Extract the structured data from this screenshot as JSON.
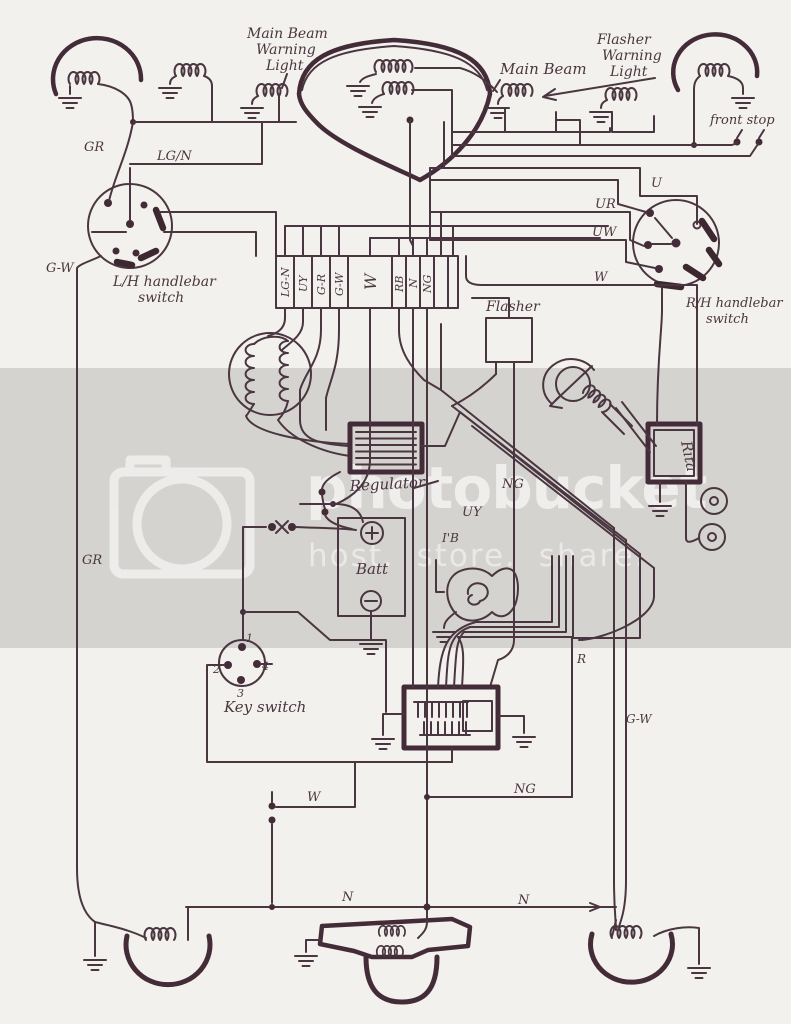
{
  "colors": {
    "paper": "#f3f1ed",
    "band": "#d5d3d0",
    "ink": "#4a3640"
  },
  "watermark": {
    "brand": "photobucket",
    "tagline": "host. store. share."
  },
  "labels": {
    "mbw1": "Main Beam",
    "mbw2": "Warning",
    "mbw3": "Light",
    "main_beam": "Main Beam",
    "fw1": "Flasher",
    "fw2": "Warning",
    "fw3": "Light",
    "front_stop": "front stop",
    "gr_top": "GR",
    "lgn": "LG/N",
    "gw_left": "G-W",
    "lh1": "L/H handlebar",
    "lh2": "switch",
    "u": "U",
    "ur": "UR",
    "uw": "UW",
    "w_right": "W",
    "rh1": "R/H handlebar",
    "rh2": "switch",
    "flasher": "Flasher",
    "regulator": "Regulator",
    "rita": "Rita",
    "batt": "Batt",
    "ng_mid": "NG",
    "uy_mid": "UY",
    "rb_mid": "I'B",
    "r_mid": "R",
    "gw_right": "G-W",
    "gr_left": "GR",
    "key": "Key switch",
    "k1": "1",
    "k2": "2",
    "k3": "3",
    "k4": "4",
    "w_bottom": "W",
    "ng_bottom": "NG",
    "n_left": "N",
    "n_right": "N"
  },
  "terminal_strip": {
    "cells": [
      "LG-N",
      "UY",
      "G-R",
      "G-W",
      "W",
      "RB",
      "N",
      "NG",
      "",
      ""
    ]
  }
}
